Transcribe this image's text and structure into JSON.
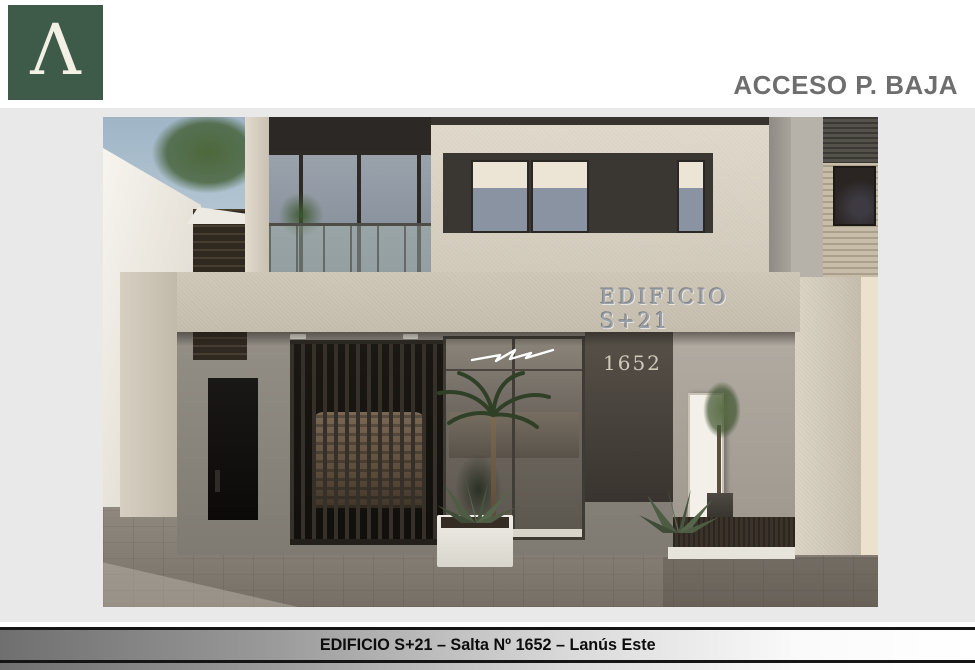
{
  "header": {
    "logo_glyph": "Λ",
    "title": "ACCESO P. BAJA"
  },
  "rendering": {
    "building_sign": "EDIFICIO S+21",
    "street_number": "1652"
  },
  "footer": {
    "caption": "EDIFICIO S+21 – Salta Nº 1652 – Lanús Este"
  },
  "colors": {
    "logo_green": "#3E5A49",
    "header_text_gray": "#6E6E6E",
    "backdrop_gray": "#E9E9E9",
    "facade_beige": "#D2CBBC",
    "window_band_dark": "#3A3632",
    "caption_gradient_start": "#6F6F6F",
    "caption_gradient_end": "#FFFFFF",
    "caption_border_black": "#151515"
  }
}
